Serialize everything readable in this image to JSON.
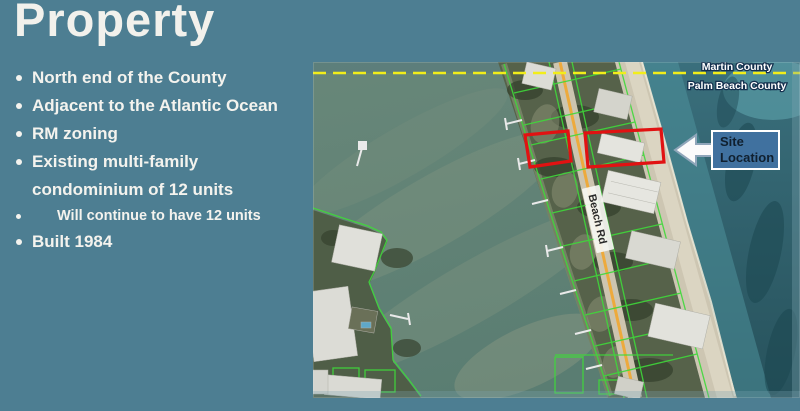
{
  "slide": {
    "title": "Property",
    "bullets": [
      {
        "text": "North end of the County",
        "level": 1
      },
      {
        "text": "Adjacent to the Atlantic Ocean",
        "level": 1
      },
      {
        "text": "RM zoning",
        "level": 1
      },
      {
        "text": "Existing multi-family\ncondominium of 12 units",
        "level": 1
      },
      {
        "text": "Will continue to have 12 units",
        "level": 2
      },
      {
        "text": "Built 1984",
        "level": 1
      }
    ]
  },
  "map": {
    "county_line": {
      "top_label": "Martin County",
      "bottom_label": "Palm Beach County"
    },
    "road_label": "Beach Rd",
    "site_callout": {
      "line1": "Site",
      "line2": "Location"
    },
    "colors": {
      "background": "#4d7e92",
      "county_dash": "#f2ee1a",
      "site_box": "#40719f",
      "highlight_red": "#e11212",
      "parcel_green": "#3fd93a"
    }
  }
}
